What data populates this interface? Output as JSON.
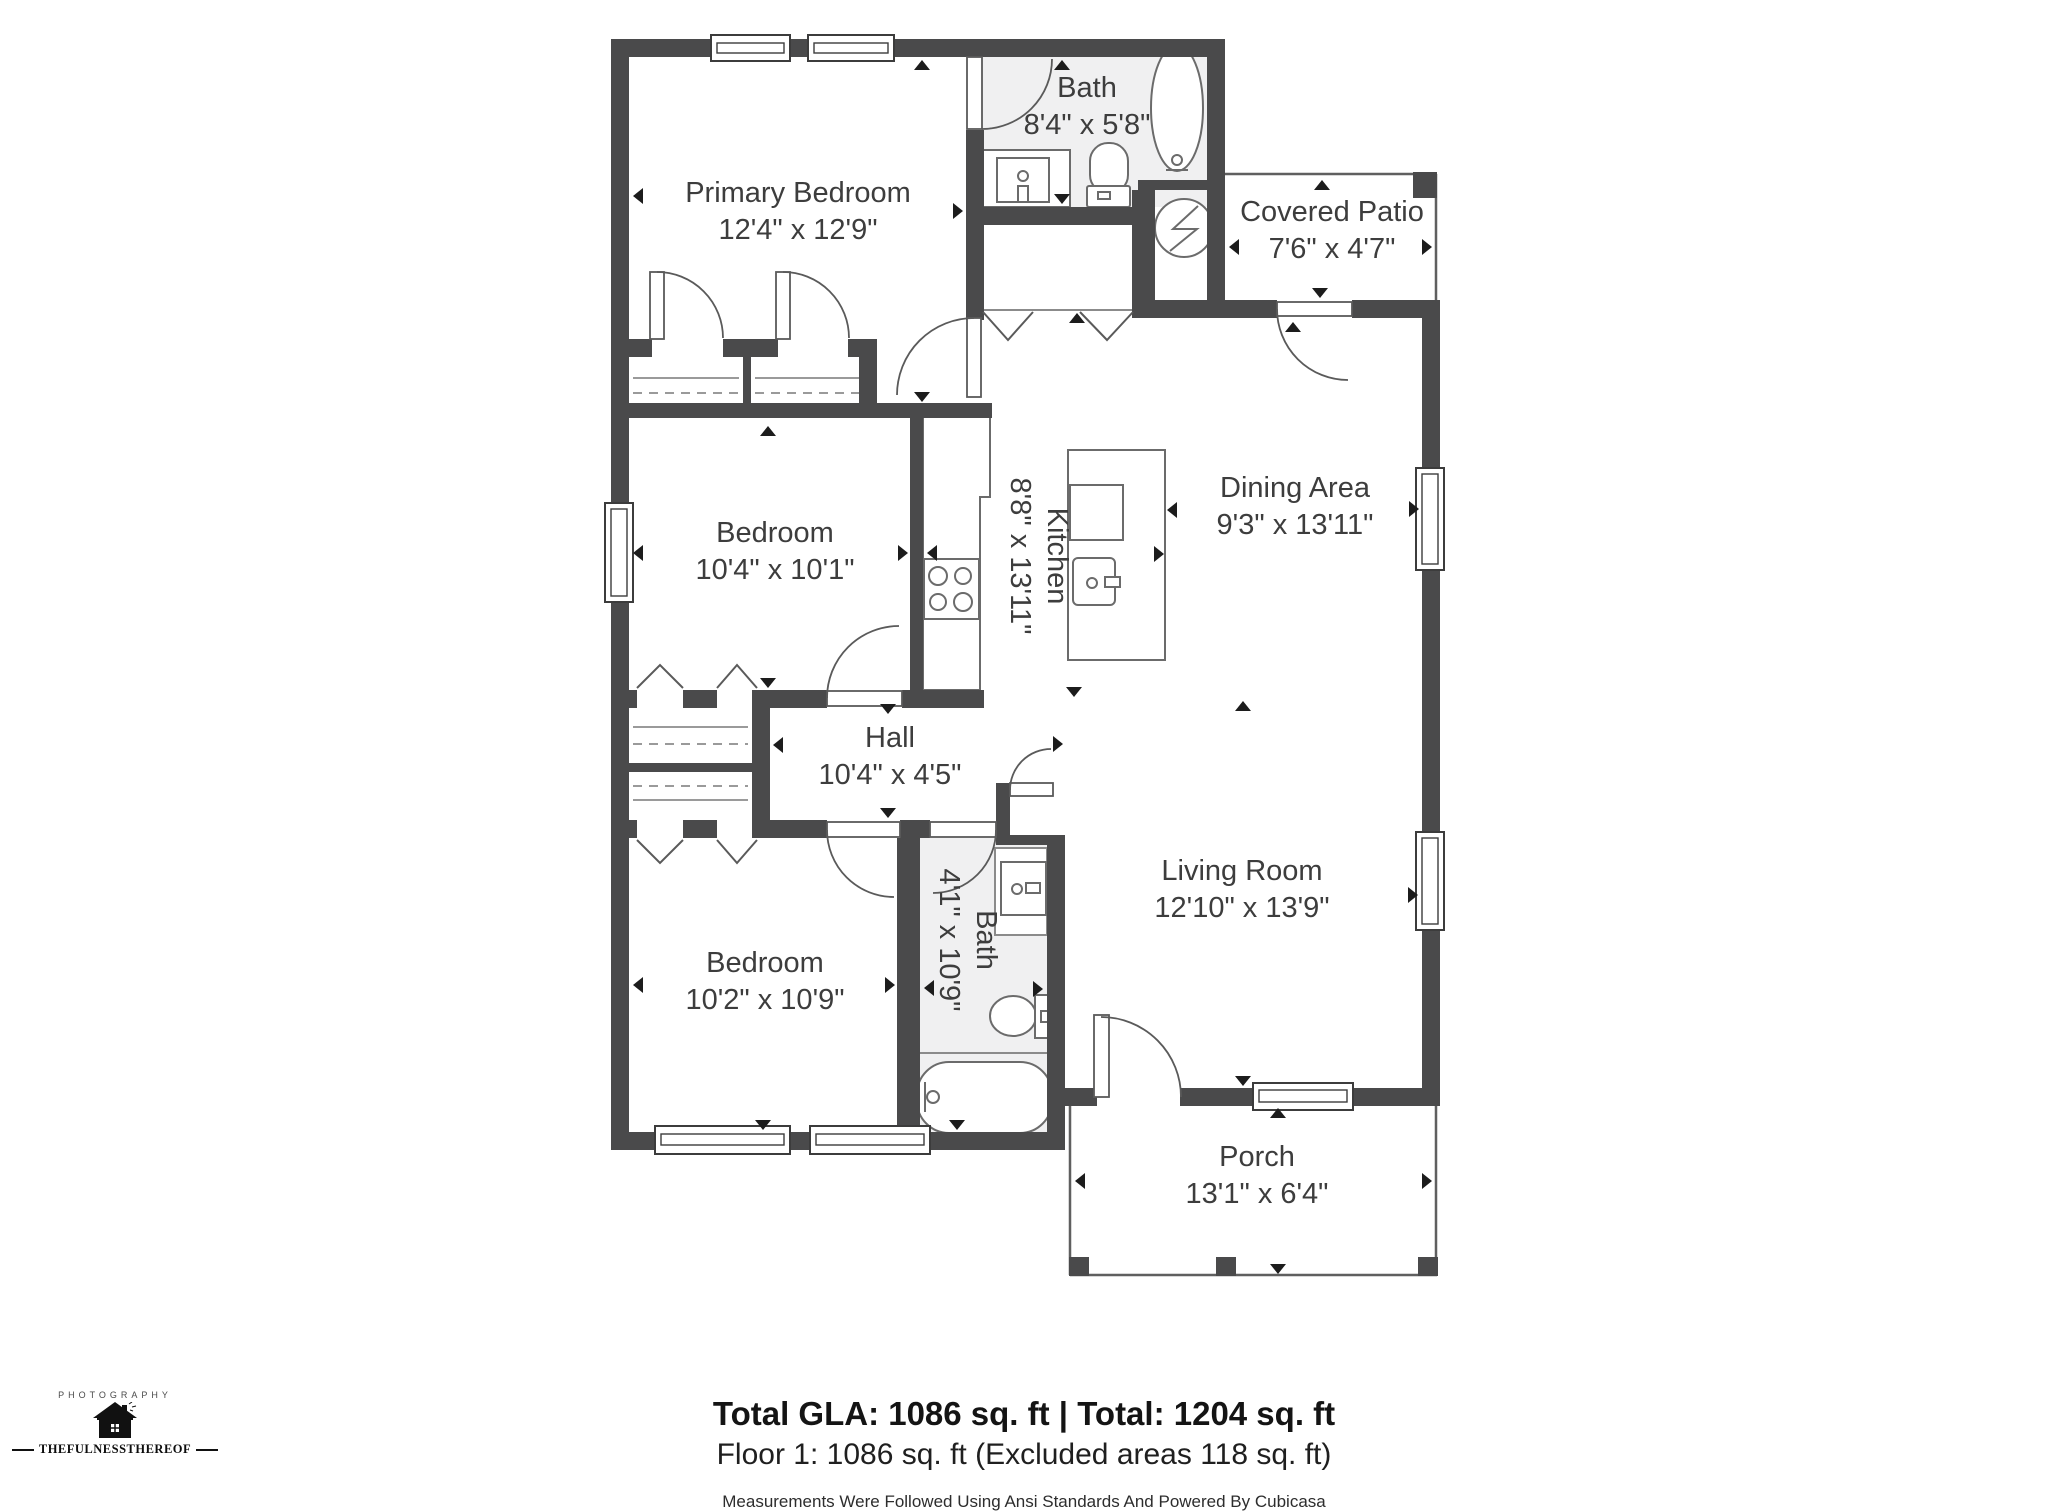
{
  "rooms": {
    "primary_bedroom": {
      "name": "Primary Bedroom",
      "dims": "12'4\" x 12'9\""
    },
    "bath_top": {
      "name": "Bath",
      "dims": "8'4\" x 5'8\""
    },
    "covered_patio": {
      "name": "Covered Patio",
      "dims": "7'6\" x 4'7\""
    },
    "bedroom_middle": {
      "name": "Bedroom",
      "dims": "10'4\" x 10'1\""
    },
    "kitchen": {
      "name": "Kitchen",
      "dims": "8'8\" x 13'11\""
    },
    "dining_area": {
      "name": "Dining Area",
      "dims": "9'3\" x 13'11\""
    },
    "hall": {
      "name": "Hall",
      "dims": "10'4\" x 4'5\""
    },
    "bath_bottom": {
      "name": "Bath",
      "dims": "4'1\" x 10'9\""
    },
    "living_room": {
      "name": "Living Room",
      "dims": "12'10\" x 13'9\""
    },
    "bedroom_bottom": {
      "name": "Bedroom",
      "dims": "10'2\" x 10'9\""
    },
    "porch": {
      "name": "Porch",
      "dims": "13'1\" x 6'4\""
    }
  },
  "footer": {
    "totals": "Total GLA: 1086 sq. ft | Total: 1204 sq. ft",
    "floor": "Floor 1: 1086 sq. ft (Excluded areas 118 sq. ft)",
    "disclaimer": "Measurements Were Followed Using Ansi Standards And Powered By Cubicasa"
  },
  "logo": {
    "top": "PHOTOGRAPHY",
    "bottom": "THEFULNESSTHEREOF"
  },
  "colors": {
    "wall": "#4a4a4b",
    "bath_floor": "#f0f0f1",
    "line": "#5f5f5f",
    "label": "#3d3d3d"
  }
}
